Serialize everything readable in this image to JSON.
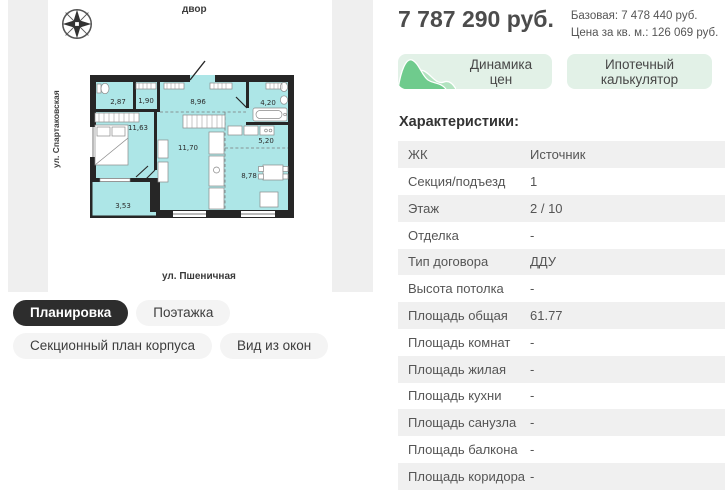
{
  "map": {
    "courtyard_label": "двор",
    "left_street": "ул. Спартаковская",
    "bottom_street": "ул. Пшеничная"
  },
  "floor_plan": {
    "rooms": [
      {
        "name": "bathroom-small",
        "area": "2,87"
      },
      {
        "name": "closet",
        "area": "1,90"
      },
      {
        "name": "hallway",
        "area": "8,96"
      },
      {
        "name": "bathroom",
        "area": "4,20"
      },
      {
        "name": "bedroom",
        "area": "11,63"
      },
      {
        "name": "living-room",
        "area": "11,70"
      },
      {
        "name": "kitchen-niche",
        "area": "5,20"
      },
      {
        "name": "dining",
        "area": "8,78"
      },
      {
        "name": "balcony",
        "area": "3,53"
      }
    ]
  },
  "tabs": {
    "items": [
      {
        "label": "Планировка",
        "active": true
      },
      {
        "label": "Поэтажка",
        "active": false
      },
      {
        "label": "Секционный план корпуса",
        "active": false
      },
      {
        "label": "Вид из окон",
        "active": false
      }
    ]
  },
  "price": {
    "main": "7 787 290 руб.",
    "base": "Базовая: 7 478 440 руб.",
    "per_sqm": "Цена за кв. м.: 126 069 руб."
  },
  "actions": {
    "price_dynamics_label": "Динамика цен",
    "mortgage_calculator_label": "Ипотечный калькулятор"
  },
  "characteristics": {
    "title": "Характеристики:",
    "rows": [
      {
        "label": "ЖК",
        "value": "Источник"
      },
      {
        "label": "Секция/подъезд",
        "value": "1"
      },
      {
        "label": "Этаж",
        "value": "2 / 10"
      },
      {
        "label": "Отделка",
        "value": "-"
      },
      {
        "label": "Тип договора",
        "value": "ДДУ"
      },
      {
        "label": "Высота потолка",
        "value": "-"
      },
      {
        "label": "Площадь общая",
        "value": "61.77"
      },
      {
        "label": "Площадь комнат",
        "value": "-"
      },
      {
        "label": "Площадь жилая",
        "value": "-"
      },
      {
        "label": "Площадь кухни",
        "value": "-"
      },
      {
        "label": "Площадь санузла",
        "value": "-"
      },
      {
        "label": "Площадь балкона",
        "value": "-"
      },
      {
        "label": "Площадь коридора",
        "value": "-"
      }
    ]
  },
  "colors": {
    "plan_interior": "#ade6e7",
    "plan_walls": "#262626",
    "street_strip": "#efefef",
    "action_button_bg": "#e2f1e7",
    "chart_green_dark": "#6fcb8d",
    "chart_green_light": "#b2e3c0",
    "tab_active_bg": "#2d2d2d",
    "table_stripe": "#f0f0f0"
  }
}
